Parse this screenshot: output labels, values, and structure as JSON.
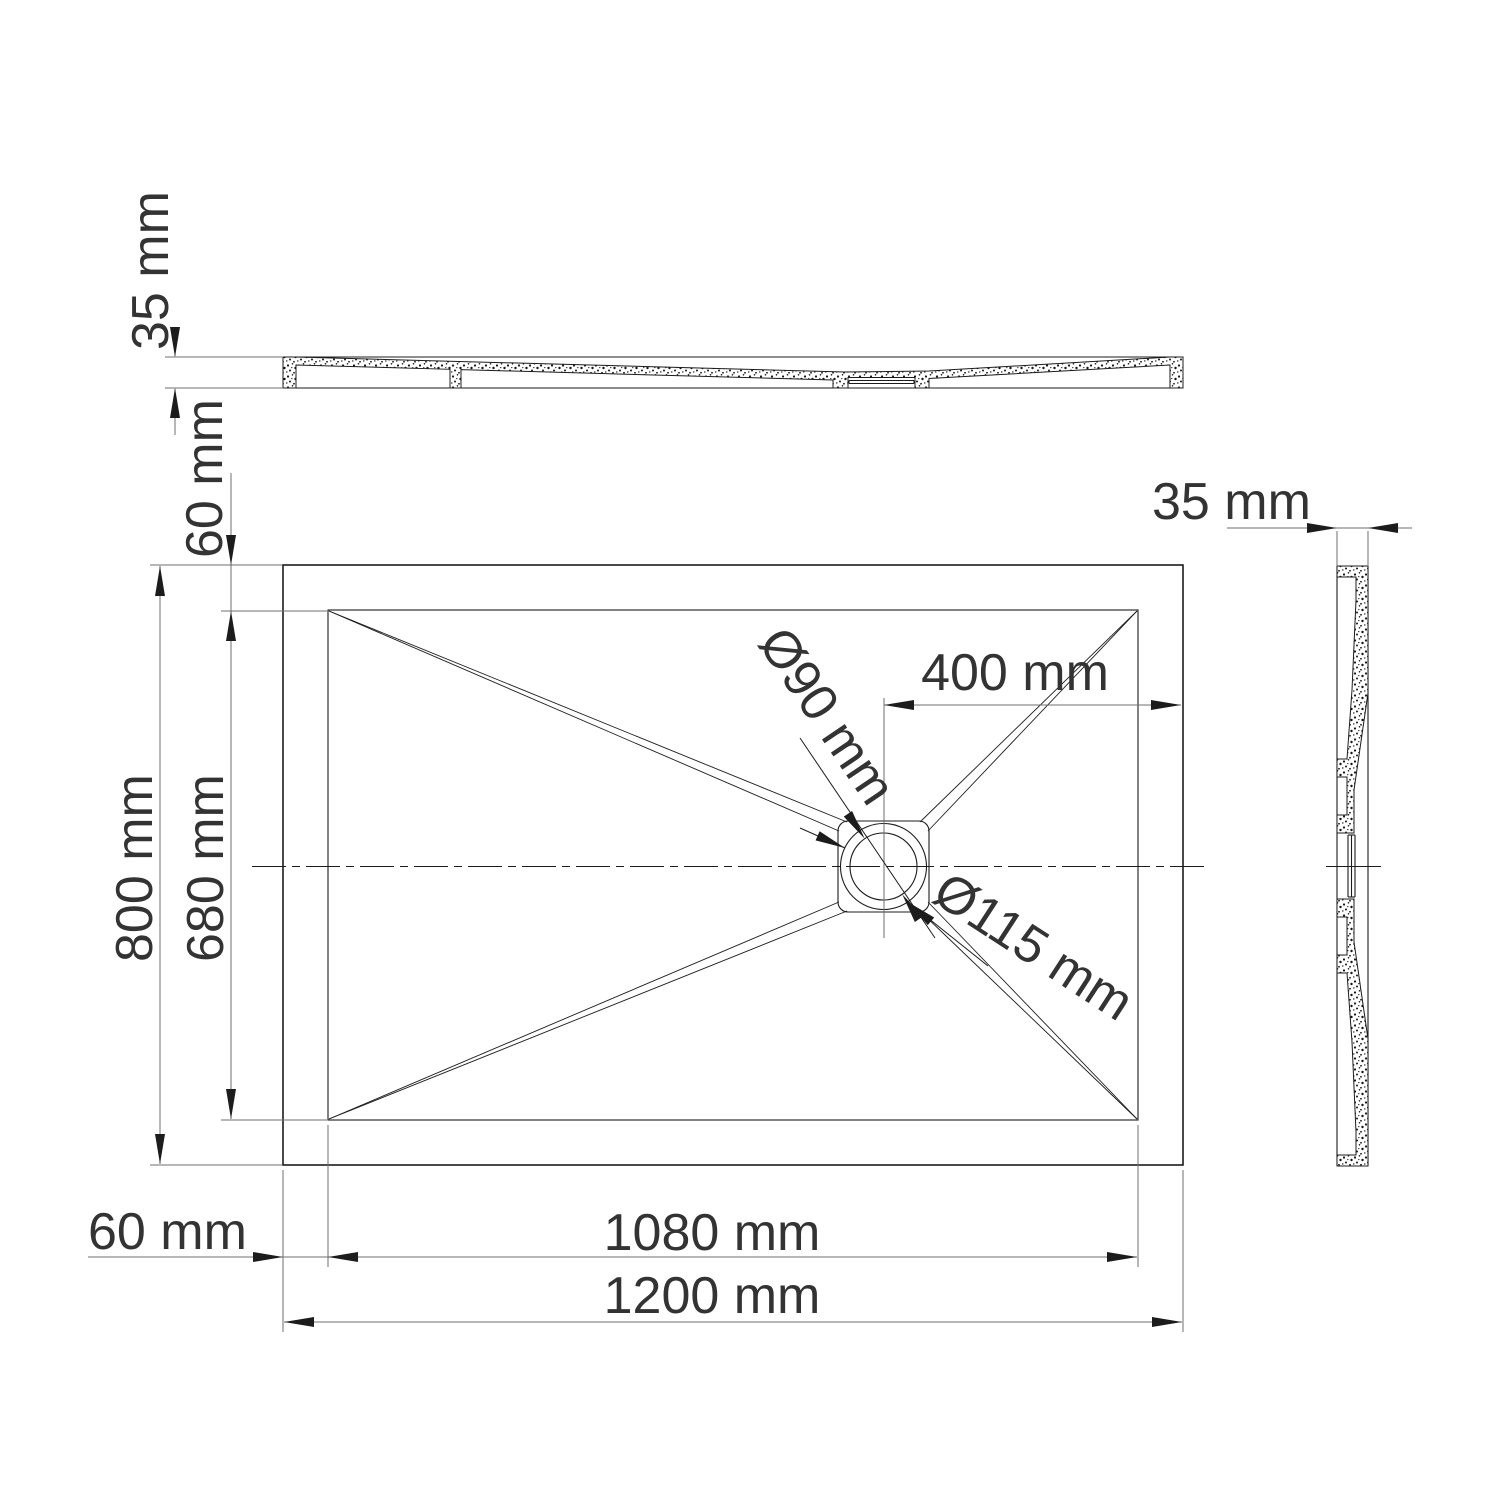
{
  "drawing": {
    "type": "shower-tray-dimension-drawing",
    "colors": {
      "line": "#1c1c1c",
      "dimension_line": "#6f6f6f",
      "text": "#333333",
      "background": "#ffffff"
    }
  },
  "labels": {
    "top_profile_thickness": "35 mm",
    "top_rim_width": "60 mm",
    "overall_width": "800 mm",
    "basin_width": "680 mm",
    "left_rim_width": "60 mm",
    "basin_length": "1080 mm",
    "overall_length": "1200 mm",
    "drain_offset": "400 mm",
    "drain_inner_diameter": "Ø90 mm",
    "drain_outer_diameter": "Ø115 mm",
    "side_profile_thickness": "35 mm"
  }
}
